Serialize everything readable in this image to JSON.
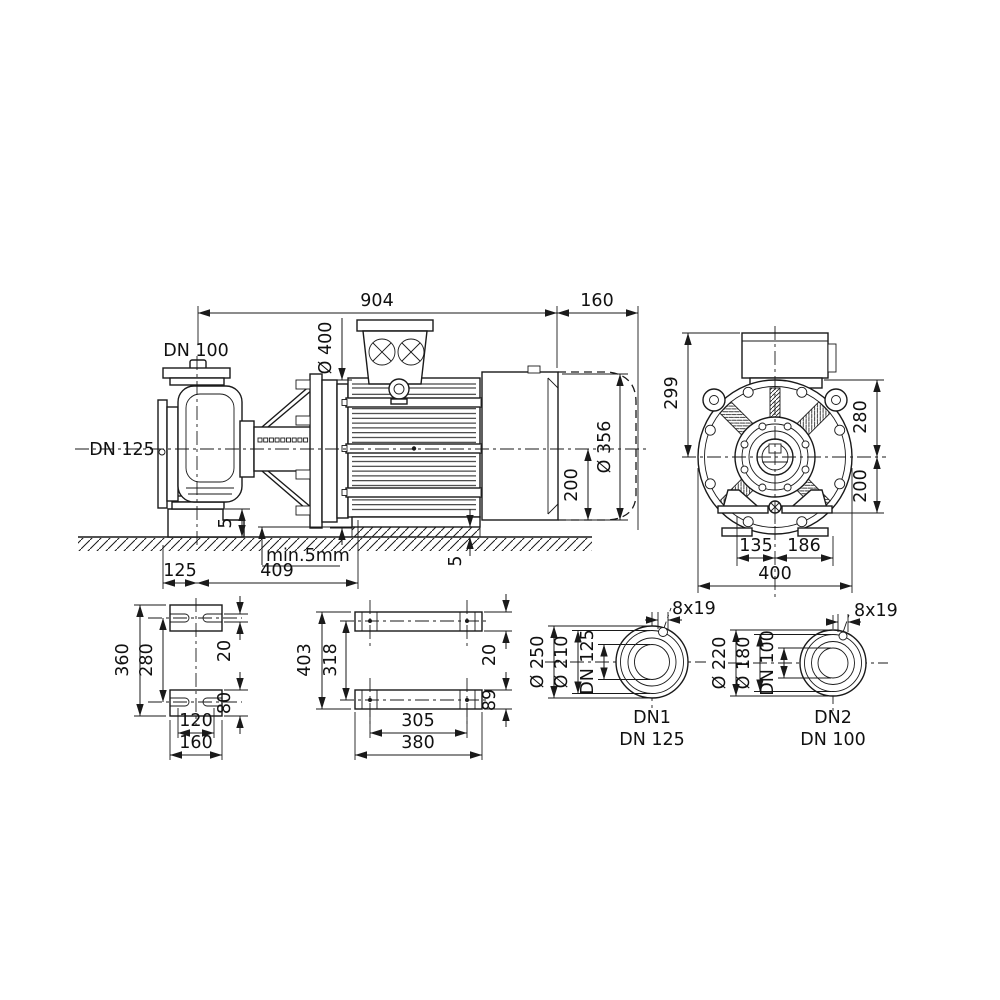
{
  "side_view": {
    "overall_length": "904",
    "extension_length": "160",
    "discharge_flange": "DN 100",
    "suction_flange": "DN 125",
    "motor_flange_dia": "Ø 400",
    "motor_dia": "Ø 356",
    "shaft_height": "200",
    "pump_grout": "5",
    "motor_grout": "5",
    "grout_note": "min.5mm",
    "foot_offset": "125",
    "foot_span": "409"
  },
  "end_view": {
    "height_above_center": "299",
    "upper_half": "280",
    "lower_half": "200",
    "foot_left": "135",
    "foot_right": "186",
    "total_width": "400"
  },
  "pump_foot_view": {
    "outer_length": "360",
    "hole_pitch": "280",
    "slot_width": "20",
    "foot_width": "80",
    "hole_spacing": "120",
    "outer_width": "160"
  },
  "motor_foot_view": {
    "outer_length": "403",
    "hole_pitch": "318",
    "plate_thickness": "20",
    "rail_width": "89",
    "hole_spacing": "305",
    "outer_width": "380"
  },
  "flange_dn1": {
    "outer_dia": "Ø 250",
    "bolt_circle_dia": "Ø 210",
    "nominal_dia": "DN 125",
    "bolt_holes": "8x19",
    "caption_line1": "DN1",
    "caption_line2": "DN 125"
  },
  "flange_dn2": {
    "outer_dia": "Ø 220",
    "bolt_circle_dia": "Ø 180",
    "nominal_dia": "DN 100",
    "bolt_holes": "8x19",
    "caption_line1": "DN2",
    "caption_line2": "DN 100"
  },
  "colors": {
    "line": "#1a1a1a",
    "background": "#ffffff"
  }
}
